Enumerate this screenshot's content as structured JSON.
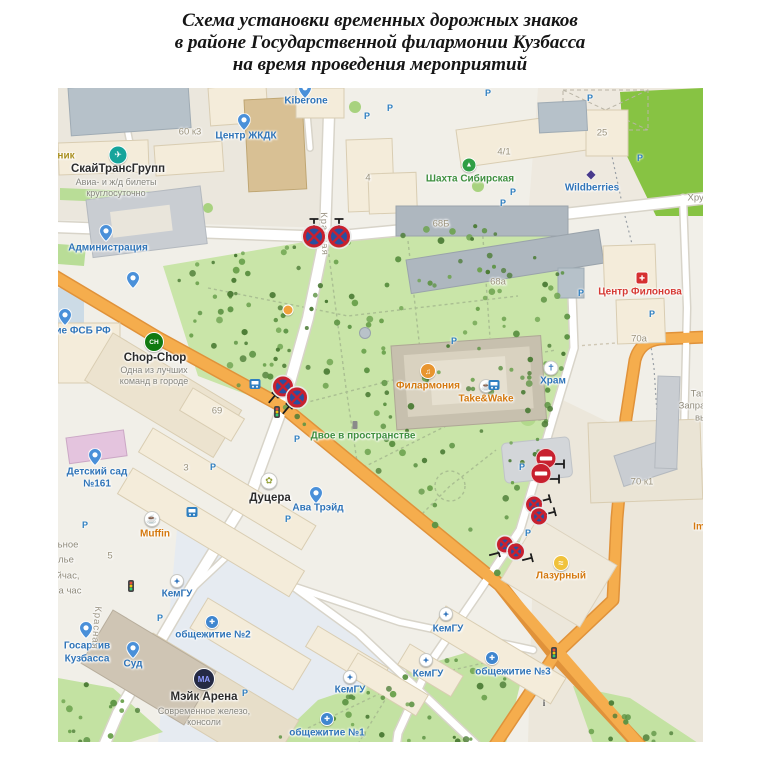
{
  "title": {
    "line1": "Схема установки временных дорожных знаков",
    "line2": "в районе Государственной филармонии Кузбасса",
    "line3": "на время проведения мероприятий"
  },
  "map": {
    "labels": [
      {
        "text": "Kiberone",
        "x": 248,
        "y": 13,
        "cls": "blue"
      },
      {
        "text": "Центр ЖКДК",
        "x": 188,
        "y": 48,
        "cls": "blue"
      },
      {
        "text": "Администрация",
        "x": 50,
        "y": 160,
        "cls": "blue"
      },
      {
        "text": "ние ФСБ РФ",
        "x": 22,
        "y": 243,
        "cls": "blue"
      },
      {
        "text": "Детский сад",
        "x": 39,
        "y": 384,
        "cls": "blue"
      },
      {
        "text": "№161",
        "x": 39,
        "y": 396,
        "cls": "blue"
      },
      {
        "text": "Ава Трэйд",
        "x": 260,
        "y": 420,
        "cls": "blue"
      },
      {
        "text": "Храм",
        "x": 495,
        "y": 293,
        "cls": "blue"
      },
      {
        "text": "КемГУ",
        "x": 119,
        "y": 506,
        "cls": "blue"
      },
      {
        "text": "КемГУ",
        "x": 292,
        "y": 602,
        "cls": "blue"
      },
      {
        "text": "КемГУ",
        "x": 390,
        "y": 541,
        "cls": "blue"
      },
      {
        "text": "КемГУ",
        "x": 370,
        "y": 586,
        "cls": "blue"
      },
      {
        "text": "общежитие №2",
        "x": 155,
        "y": 547,
        "cls": "blue"
      },
      {
        "text": "общежитие №1",
        "x": 269,
        "y": 645,
        "cls": "blue"
      },
      {
        "text": "общежитие №3",
        "x": 455,
        "y": 584,
        "cls": "blue"
      },
      {
        "text": "Госархив",
        "x": 29,
        "y": 558,
        "cls": "blue"
      },
      {
        "text": "Кузбасса",
        "x": 29,
        "y": 571,
        "cls": "blue"
      },
      {
        "text": "Суд",
        "x": 75,
        "y": 576,
        "cls": "blue"
      },
      {
        "text": "Wildberries",
        "x": 534,
        "y": 100,
        "cls": "blue"
      },
      {
        "text": "Muffin",
        "x": 97,
        "y": 446,
        "cls": "orange"
      },
      {
        "text": "Take&Wake",
        "x": 428,
        "y": 311,
        "cls": "orange"
      },
      {
        "text": "Филармония",
        "x": 370,
        "y": 298,
        "cls": "orange"
      },
      {
        "text": "Лазурный",
        "x": 503,
        "y": 488,
        "cls": "orange"
      },
      {
        "text": "Im",
        "x": 641,
        "y": 439,
        "cls": "orange"
      },
      {
        "text": "Шахта Сибирская",
        "x": 412,
        "y": 91,
        "cls": "green"
      },
      {
        "text": "Двое в пространстве",
        "x": 305,
        "y": 348,
        "cls": "green"
      },
      {
        "text": "Центр Филонова",
        "x": 582,
        "y": 204,
        "cls": "red"
      },
      {
        "text": "СкайТрансГрупп",
        "x": 60,
        "y": 81,
        "cls": "dark"
      },
      {
        "text": "Chop-Chop",
        "x": 97,
        "y": 270,
        "cls": "dark"
      },
      {
        "text": "Дуцера",
        "x": 212,
        "y": 410,
        "cls": "dark"
      },
      {
        "text": "Мэйк Арена",
        "x": 146,
        "y": 609,
        "cls": "dark"
      },
      {
        "text": "Авиа- и ж/д билеты",
        "x": 58,
        "y": 94,
        "cls": "sub"
      },
      {
        "text": "круглосуточно",
        "x": 58,
        "y": 105,
        "cls": "sub"
      },
      {
        "text": "Одна из лучших",
        "x": 96,
        "y": 282,
        "cls": "sub"
      },
      {
        "text": "команд в городе",
        "x": 96,
        "y": 293,
        "cls": "sub"
      },
      {
        "text": "Современное железо,",
        "x": 146,
        "y": 623,
        "cls": "sub"
      },
      {
        "text": "консоли",
        "x": 146,
        "y": 634,
        "cls": "sub"
      },
      {
        "text": "60 к3",
        "x": 132,
        "y": 44,
        "cls": "num"
      },
      {
        "text": "4",
        "x": 310,
        "y": 90,
        "cls": "num"
      },
      {
        "text": "4/1",
        "x": 446,
        "y": 64,
        "cls": "num"
      },
      {
        "text": "25",
        "x": 544,
        "y": 45,
        "cls": "num"
      },
      {
        "text": "68Б",
        "x": 383,
        "y": 136,
        "cls": "num"
      },
      {
        "text": "68а",
        "x": 440,
        "y": 194,
        "cls": "num"
      },
      {
        "text": "70а",
        "x": 581,
        "y": 251,
        "cls": "num"
      },
      {
        "text": "70 к1",
        "x": 584,
        "y": 394,
        "cls": "num"
      },
      {
        "text": "69",
        "x": 159,
        "y": 323,
        "cls": "num"
      },
      {
        "text": "3",
        "x": 128,
        "y": 380,
        "cls": "num"
      },
      {
        "text": "5",
        "x": 52,
        "y": 468,
        "cls": "num"
      },
      {
        "text": "Хрус",
        "x": 640,
        "y": 110,
        "cls": "gray"
      },
      {
        "text": "Тат",
        "x": 640,
        "y": 306,
        "cls": "gray"
      },
      {
        "text": "Запра",
        "x": 634,
        "y": 318,
        "cls": "gray"
      },
      {
        "text": "вь",
        "x": 642,
        "y": 330,
        "cls": "gray"
      },
      {
        "text": "ьное",
        "x": 10,
        "y": 457,
        "cls": "gray"
      },
      {
        "text": "лье",
        "x": 8,
        "y": 472,
        "cls": "gray"
      },
      {
        "text": "йчас,",
        "x": 10,
        "y": 488,
        "cls": "gray"
      },
      {
        "text": "а час",
        "x": 12,
        "y": 503,
        "cls": "gray"
      },
      {
        "text": "ник",
        "x": 8,
        "y": 68,
        "cls": "olive"
      },
      {
        "text": "Красная",
        "x": 266,
        "y": 146,
        "cls": "street",
        "rot": 88
      },
      {
        "text": "Красная",
        "x": 38,
        "y": 540,
        "cls": "street",
        "rot": 95
      }
    ],
    "signs": [
      {
        "type": "no-stopping",
        "x": 256,
        "y": 151,
        "r": 11,
        "pole": {
          "dx": 0,
          "dy": -15,
          "rot": 0
        }
      },
      {
        "type": "no-stopping",
        "x": 281,
        "y": 151,
        "r": 11,
        "pole": {
          "dx": 0,
          "dy": -15,
          "rot": 0
        }
      },
      {
        "type": "no-stopping",
        "x": 225,
        "y": 301,
        "r": 10,
        "pole": {
          "dx": -11,
          "dy": 10,
          "rot": 40
        }
      },
      {
        "type": "no-stopping",
        "x": 239,
        "y": 312,
        "r": 10,
        "pole": {
          "dx": -11,
          "dy": 10,
          "rot": 40
        }
      },
      {
        "type": "no-entry",
        "x": 488,
        "y": 373,
        "r": 10,
        "pole": {
          "dx": 13,
          "dy": 3,
          "rot": 90
        }
      },
      {
        "type": "no-entry",
        "x": 483,
        "y": 388,
        "r": 10,
        "pole": {
          "dx": 13,
          "dy": 3,
          "rot": 90
        }
      },
      {
        "type": "no-stopping",
        "x": 476,
        "y": 419,
        "r": 8,
        "pole": {
          "dx": 11,
          "dy": -7,
          "rot": 75
        }
      },
      {
        "type": "no-stopping",
        "x": 481,
        "y": 431,
        "r": 8,
        "pole": {
          "dx": 11,
          "dy": -6,
          "rot": 75
        }
      },
      {
        "type": "no-stopping",
        "x": 447,
        "y": 459,
        "r": 8,
        "pole": {
          "dx": -11,
          "dy": 7,
          "rot": 75
        }
      },
      {
        "type": "no-stopping",
        "x": 458,
        "y": 466,
        "r": 8,
        "pole": {
          "dx": 11,
          "dy": 5,
          "rot": 75
        }
      }
    ],
    "parkings": [
      {
        "x": 332,
        "y": 20
      },
      {
        "x": 309,
        "y": 28
      },
      {
        "x": 430,
        "y": 5
      },
      {
        "x": 455,
        "y": 104
      },
      {
        "x": 445,
        "y": 115
      },
      {
        "x": 532,
        "y": 10
      },
      {
        "x": 582,
        "y": 70
      },
      {
        "x": 523,
        "y": 205
      },
      {
        "x": 594,
        "y": 226
      },
      {
        "x": 239,
        "y": 351
      },
      {
        "x": 396,
        "y": 253
      },
      {
        "x": 464,
        "y": 379
      },
      {
        "x": 470,
        "y": 445
      },
      {
        "x": 155,
        "y": 379
      },
      {
        "x": 230,
        "y": 431
      },
      {
        "x": 27,
        "y": 437
      },
      {
        "x": 102,
        "y": 530
      },
      {
        "x": 187,
        "y": 605
      }
    ],
    "icons": [
      {
        "kind": "pin",
        "x": 247,
        "y": 2,
        "name": "kiberone-pin"
      },
      {
        "kind": "pin",
        "x": 186,
        "y": 34,
        "name": "zhkdk-pin"
      },
      {
        "kind": "pin",
        "x": 48,
        "y": 145,
        "name": "administracia-pin"
      },
      {
        "kind": "pin",
        "x": 75,
        "y": 192,
        "name": "poi-pin"
      },
      {
        "kind": "pin",
        "x": 7,
        "y": 229,
        "name": "fsb-pin"
      },
      {
        "kind": "pin",
        "x": 37,
        "y": 369,
        "name": "detsad-pin"
      },
      {
        "kind": "pin",
        "x": 258,
        "y": 407,
        "name": "ava-trade-pin"
      },
      {
        "kind": "pin",
        "x": 28,
        "y": 542,
        "name": "gosarhiv-pin"
      },
      {
        "kind": "pin",
        "x": 75,
        "y": 562,
        "name": "sud-pin"
      },
      {
        "kind": "univ",
        "x": 119,
        "y": 493,
        "name": "kemgu-icon"
      },
      {
        "kind": "univ",
        "x": 292,
        "y": 589,
        "name": "kemgu-icon"
      },
      {
        "kind": "univ",
        "x": 388,
        "y": 526,
        "name": "kemgu-icon"
      },
      {
        "kind": "univ",
        "x": 368,
        "y": 572,
        "name": "kemgu-icon"
      },
      {
        "kind": "dorm",
        "x": 154,
        "y": 534,
        "name": "dorm2-icon"
      },
      {
        "kind": "dorm",
        "x": 269,
        "y": 631,
        "name": "dorm1-icon"
      },
      {
        "kind": "dorm",
        "x": 434,
        "y": 570,
        "name": "dorm3-icon"
      },
      {
        "kind": "hram",
        "x": 493,
        "y": 280,
        "name": "church-icon"
      },
      {
        "kind": "shahta",
        "x": 411,
        "y": 77,
        "name": "shahta-sibirskaya-icon"
      },
      {
        "kind": "skytrans",
        "x": 60,
        "y": 67,
        "name": "skytransgroup-icon"
      },
      {
        "kind": "chop",
        "x": 96,
        "y": 254,
        "name": "chop-chop-icon"
      },
      {
        "kind": "mejk",
        "x": 146,
        "y": 591,
        "name": "make-arena-icon"
      },
      {
        "kind": "muffin",
        "x": 94,
        "y": 431,
        "name": "muffin-icon"
      },
      {
        "kind": "ducera",
        "x": 211,
        "y": 393,
        "name": "ducera-icon"
      },
      {
        "kind": "take",
        "x": 428,
        "y": 298,
        "name": "take-wake-icon"
      },
      {
        "kind": "filarm",
        "x": 370,
        "y": 283,
        "name": "philharmonic-icon"
      },
      {
        "kind": "lazur",
        "x": 503,
        "y": 475,
        "name": "lazurny-icon"
      },
      {
        "kind": "filonov",
        "x": 584,
        "y": 190,
        "name": "filonov-center-icon"
      },
      {
        "kind": "wb",
        "x": 533,
        "y": 86,
        "name": "wildberries-icon"
      },
      {
        "kind": "bus",
        "x": 197,
        "y": 296,
        "name": "bus-stop-icon"
      },
      {
        "kind": "bus",
        "x": 436,
        "y": 297,
        "name": "bus-stop-icon"
      },
      {
        "kind": "bus",
        "x": 134,
        "y": 424,
        "name": "bus-stop-icon"
      },
      {
        "kind": "tlight",
        "x": 219,
        "y": 324,
        "name": "traffic-light-icon"
      },
      {
        "kind": "tlight",
        "x": 73,
        "y": 498,
        "name": "traffic-light-icon"
      },
      {
        "kind": "tlight",
        "x": 496,
        "y": 565,
        "name": "traffic-light-icon"
      },
      {
        "kind": "fontan",
        "x": 307,
        "y": 245,
        "name": "fountain-icon"
      },
      {
        "kind": "odot",
        "x": 230,
        "y": 222,
        "name": "poi-dot-icon"
      },
      {
        "kind": "statue",
        "x": 297,
        "y": 337,
        "name": "monument-icon"
      },
      {
        "kind": "info",
        "x": 486,
        "y": 615,
        "name": "info-icon"
      }
    ],
    "sign_colors": {
      "no_stopping_blue": "#2a4fa0",
      "sign_red": "#c8202f",
      "road_orange": "#f5ad4d"
    }
  }
}
